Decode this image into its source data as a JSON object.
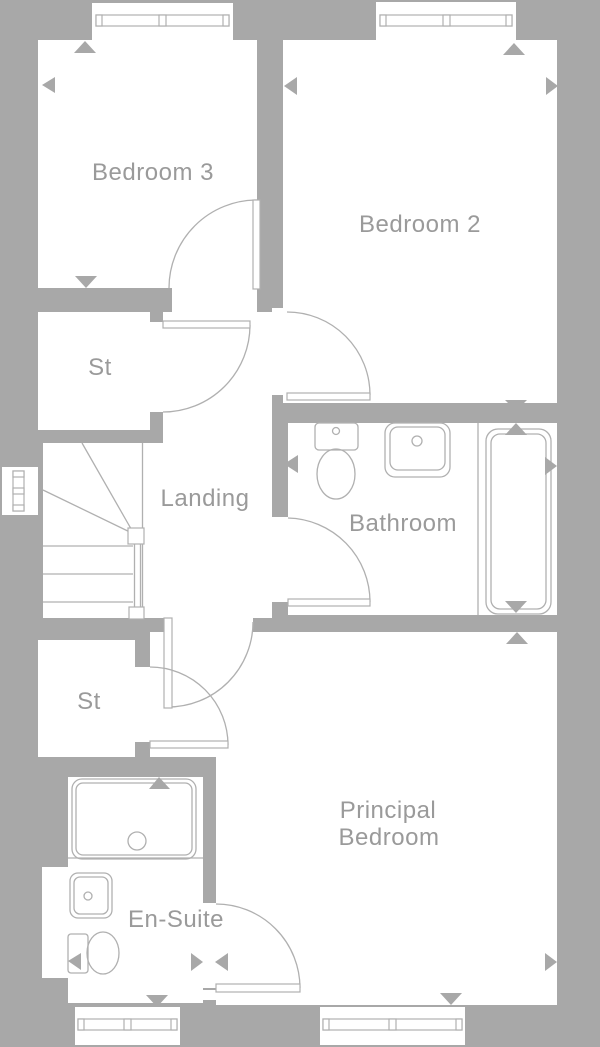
{
  "title": "First floor plan",
  "colors": {
    "wall": "#a8a8a8",
    "room": "#ffffff",
    "line": "#b0b0b0",
    "text": "#9a9a9a"
  },
  "rooms": {
    "bedroom3": {
      "label": "Bedroom 3"
    },
    "bedroom2": {
      "label": "Bedroom 2"
    },
    "storage1": {
      "label": "St"
    },
    "landing": {
      "label": "Landing"
    },
    "bathroom": {
      "label": "Bathroom"
    },
    "storage2": {
      "label": "St"
    },
    "principal": {
      "label_line1": "Principal",
      "label_line2": "Bedroom"
    },
    "ensuite": {
      "label": "En-Suite"
    }
  },
  "fixtures": {
    "bathroom": [
      "toilet",
      "basin",
      "bath"
    ],
    "ensuite": [
      "shower-tray",
      "basin",
      "toilet"
    ],
    "stairs": "staircase-with-winders"
  },
  "window_count": 6,
  "door_count": 7
}
